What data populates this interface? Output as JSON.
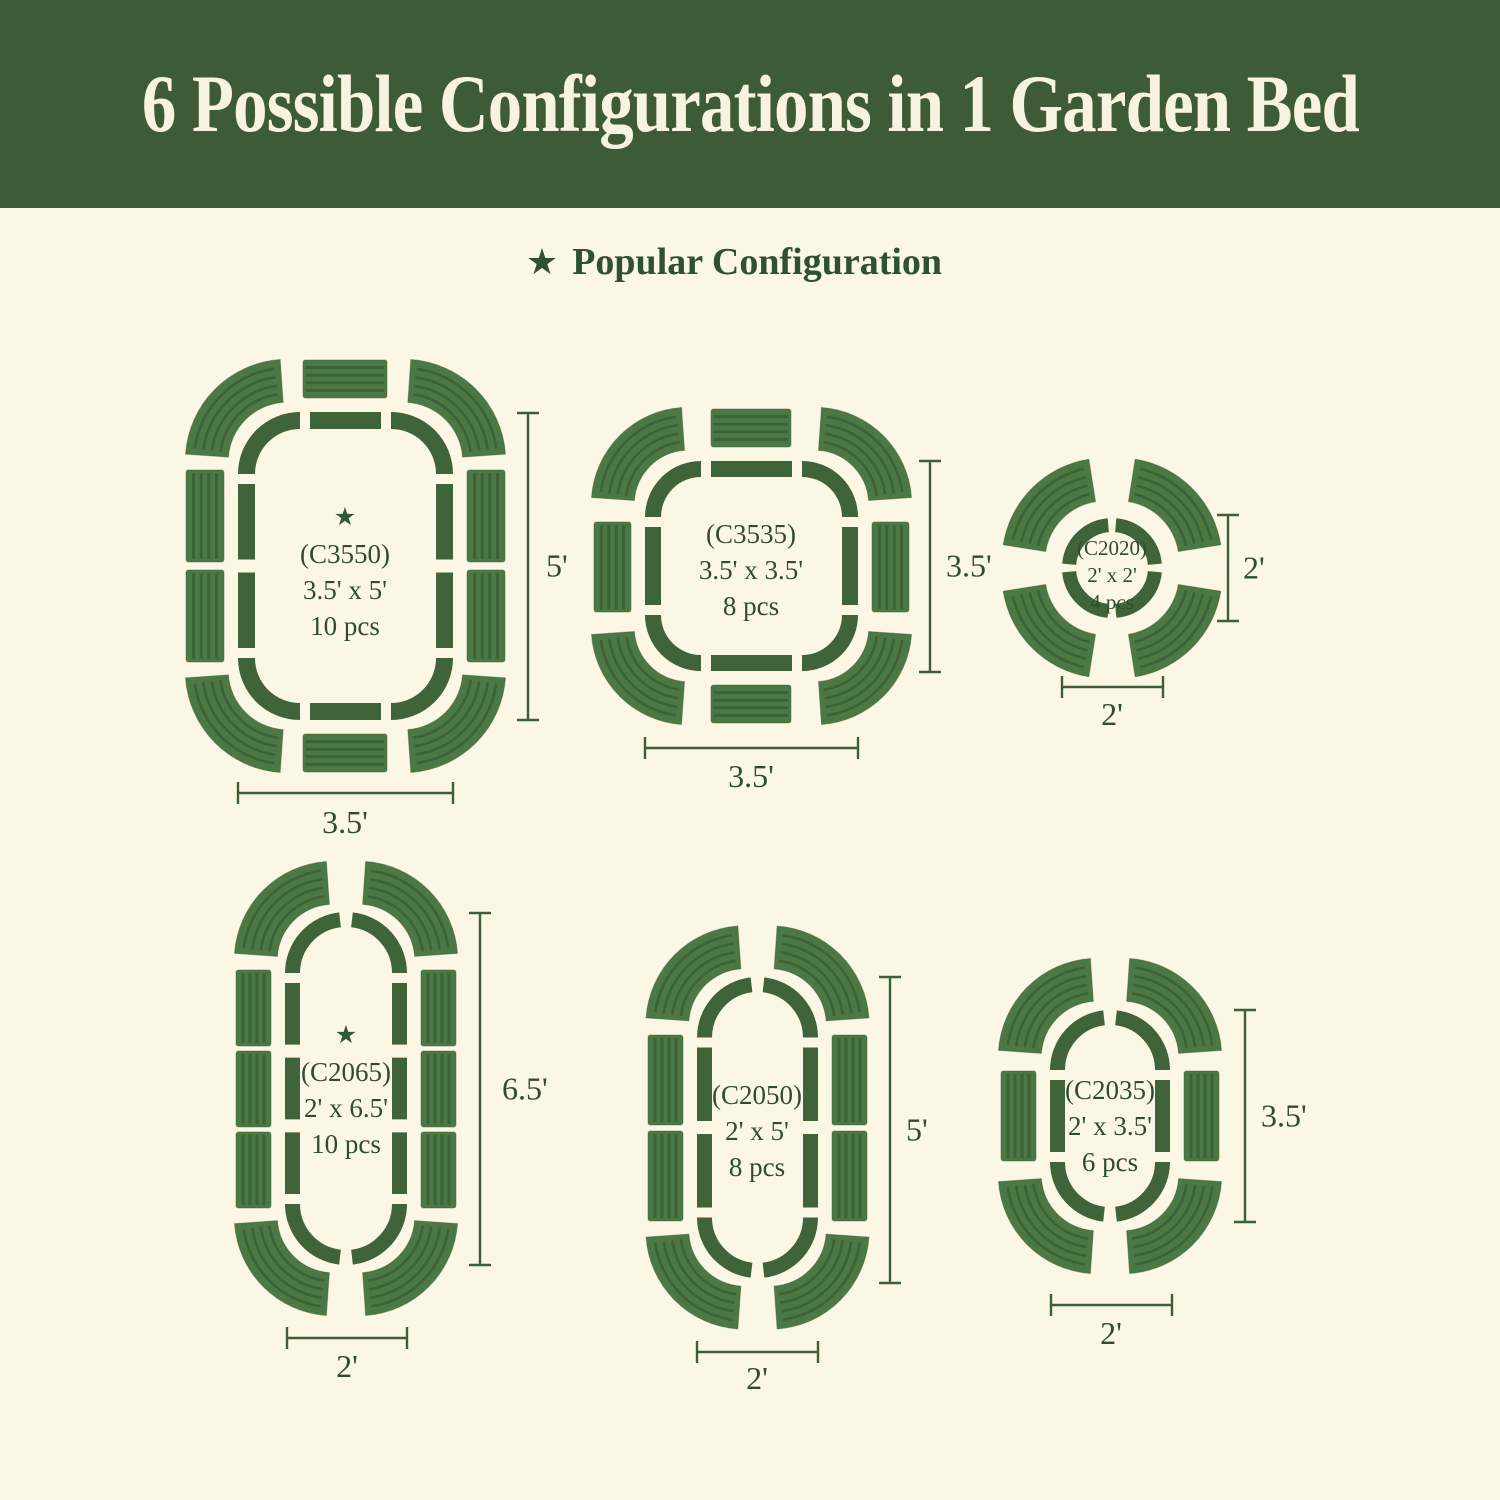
{
  "header": {
    "title": "6 Possible Configurations in 1 Garden Bed"
  },
  "legend": {
    "star": "★",
    "label": "Popular Configuration"
  },
  "configs": [
    {
      "id": "c3550",
      "code": "(C3550)",
      "size": "3.5' x 5'",
      "pieces": "10 pcs",
      "popular": true,
      "height_label": "5'",
      "width_label": "3.5'"
    },
    {
      "id": "c3535",
      "code": "(C3535)",
      "size": "3.5' x 3.5'",
      "pieces": "8 pcs",
      "popular": false,
      "height_label": "3.5'",
      "width_label": "3.5'"
    },
    {
      "id": "c2020",
      "code": "(C2020)",
      "size": "2' x 2'",
      "pieces": "4 pcs",
      "popular": false,
      "height_label": "2'",
      "width_label": "2'"
    },
    {
      "id": "c2065",
      "code": "(C2065)",
      "size": "2' x 6.5'",
      "pieces": "10 pcs",
      "popular": true,
      "height_label": "6.5'",
      "width_label": "2'"
    },
    {
      "id": "c2050",
      "code": "(C2050)",
      "size": "2' x 5'",
      "pieces": "8 pcs",
      "popular": false,
      "height_label": "5'",
      "width_label": "2'"
    },
    {
      "id": "c2035",
      "code": "(C2035)",
      "size": "2' x 3.5'",
      "pieces": "6 pcs",
      "popular": false,
      "height_label": "3.5'",
      "width_label": "2'"
    }
  ],
  "colors": {
    "header_bg": "#3e5b37",
    "title_text": "#f8f3e1",
    "background": "#fcf6e5",
    "outline": "#3f6439",
    "panel": "#4c7845",
    "panel_ridge": "#3a5f36",
    "text": "#2c4e2f",
    "dimension": "#3c5f38"
  }
}
